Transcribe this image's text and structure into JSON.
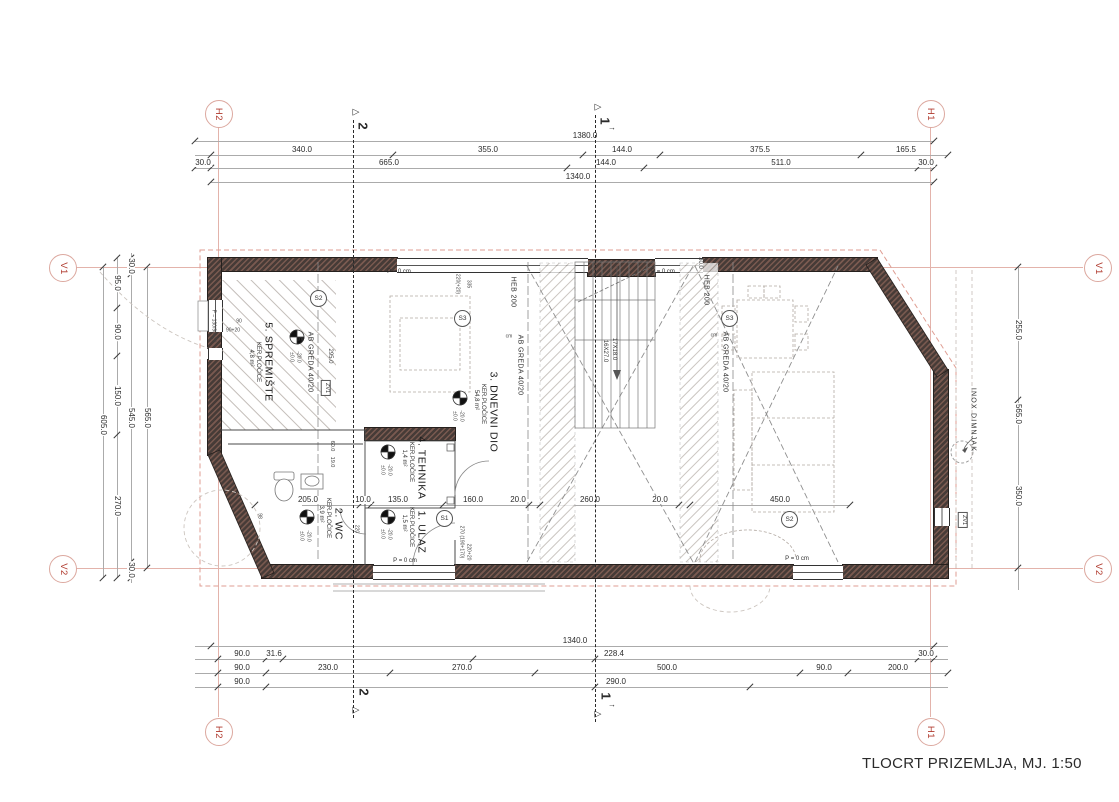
{
  "title": {
    "text": "TLOCRT PRIZEMLJA, MJ. 1:50"
  },
  "colors": {
    "wall": "#463b37",
    "wall_hatch": "#7a5a50",
    "grid_red": "#b03a2e",
    "grid_line": "#e3b3ab",
    "roof_dashed": "#df9e93",
    "dim_text": "#2b2b2b"
  },
  "grid": {
    "markers": [
      {
        "t": "H2",
        "x": 218,
        "y": 113
      },
      {
        "t": "H1",
        "x": 930,
        "y": 113
      },
      {
        "t": "V1",
        "x": 62,
        "y": 267
      },
      {
        "t": "V1",
        "x": 1097,
        "y": 267
      },
      {
        "t": "V2",
        "x": 62,
        "y": 568
      },
      {
        "t": "V2",
        "x": 1097,
        "y": 568
      },
      {
        "t": "H2",
        "x": 218,
        "y": 731
      },
      {
        "t": "H1",
        "x": 930,
        "y": 731
      }
    ],
    "lines": [
      {
        "o": "v",
        "x": 218,
        "y1": 127,
        "y2": 717
      },
      {
        "o": "v",
        "x": 930,
        "y1": 127,
        "y2": 717
      },
      {
        "o": "h",
        "y": 267,
        "x1": 76,
        "x2": 1083
      },
      {
        "o": "h",
        "y": 568,
        "x1": 76,
        "x2": 1083
      }
    ]
  },
  "sections": [
    {
      "label": "2",
      "x": 353,
      "y1": 120,
      "y2": 718
    },
    {
      "label": "1",
      "x": 595,
      "y1": 115,
      "y2": 722
    }
  ],
  "dimensions": {
    "h_rows": [
      {
        "y": 141,
        "x1": 195,
        "x2": 934,
        "ticks": [
          195,
          934
        ],
        "labels": [
          {
            "t": "1380.0",
            "x": 585
          }
        ]
      },
      {
        "y": 155,
        "x1": 195,
        "x2": 948,
        "ticks": [
          211,
          393,
          583,
          660,
          861,
          948
        ],
        "labels": [
          {
            "t": "340.0",
            "x": 302
          },
          {
            "t": "355.0",
            "x": 488
          },
          {
            "t": "144.0",
            "x": 622
          },
          {
            "t": "375.5",
            "x": 760
          },
          {
            "t": "165.5",
            "x": 906
          }
        ]
      },
      {
        "y": 168,
        "x1": 195,
        "x2": 934,
        "ticks": [
          195,
          211,
          567,
          644,
          918,
          934
        ],
        "labels": [
          {
            "t": "30.0",
            "x": 203
          },
          {
            "t": "665.0",
            "x": 389
          },
          {
            "t": "144.0",
            "x": 606
          },
          {
            "t": "511.0",
            "x": 781
          },
          {
            "t": "30.0",
            "x": 926
          }
        ]
      },
      {
        "y": 182,
        "x1": 211,
        "x2": 934,
        "ticks": [
          211,
          934
        ],
        "labels": [
          {
            "t": "1340.0",
            "x": 578
          }
        ]
      },
      {
        "y": 505,
        "x1": 302,
        "x2": 850,
        "ticks": [
          255,
          360,
          371,
          443,
          529,
          540,
          679,
          690,
          850
        ],
        "labels": [
          {
            "t": "205.0",
            "x": 308
          },
          {
            "t": "10.0",
            "x": 363
          },
          {
            "t": "135.0",
            "x": 398
          },
          {
            "t": "160.0",
            "x": 473
          },
          {
            "t": "20.0",
            "x": 518
          },
          {
            "t": "260.0",
            "x": 590
          },
          {
            "t": "20.0",
            "x": 660
          },
          {
            "t": "450.0",
            "x": 780
          }
        ]
      },
      {
        "y": 646,
        "x1": 195,
        "x2": 948,
        "ticks": [
          211,
          934
        ],
        "labels": [
          {
            "t": "1340.0",
            "x": 575
          }
        ]
      },
      {
        "y": 659,
        "x1": 195,
        "x2": 948,
        "ticks": [
          218,
          266,
          283,
          473,
          595,
          918,
          934
        ],
        "labels": [
          {
            "t": "90.0",
            "x": 242
          },
          {
            "t": "31.6",
            "x": 274
          },
          {
            "t": "228.4",
            "x": 614
          },
          {
            "t": "30.0",
            "x": 926
          }
        ]
      },
      {
        "y": 673,
        "x1": 195,
        "x2": 948,
        "ticks": [
          218,
          266,
          390,
          535,
          800,
          848,
          948
        ],
        "labels": [
          {
            "t": "90.0",
            "x": 242
          },
          {
            "t": "230.0",
            "x": 328
          },
          {
            "t": "270.0",
            "x": 462
          },
          {
            "t": "500.0",
            "x": 667
          },
          {
            "t": "90.0",
            "x": 824
          },
          {
            "t": "200.0",
            "x": 898
          }
        ]
      },
      {
        "y": 687,
        "x1": 195,
        "x2": 948,
        "ticks": [
          218,
          266,
          595,
          750
        ],
        "labels": [
          {
            "t": "90.0",
            "x": 242
          },
          {
            "t": "290.0",
            "x": 616
          }
        ]
      }
    ],
    "v_cols": [
      {
        "x": 103,
        "y1": 267,
        "y2": 578,
        "ticks": [
          267,
          578
        ],
        "labels": [
          {
            "t": "605.0",
            "y": 425
          }
        ]
      },
      {
        "x": 117,
        "y1": 258,
        "y2": 578,
        "ticks": [
          258,
          308,
          356,
          435,
          578
        ],
        "labels": [
          {
            "t": "95.0",
            "y": 283
          },
          {
            "t": "90.0",
            "y": 332
          },
          {
            "t": "150.0",
            "y": 396
          },
          {
            "t": "270.0",
            "y": 506
          }
        ]
      },
      {
        "x": 131,
        "y1": 253,
        "y2": 583,
        "ticks": [
          258,
          274,
          562,
          578
        ],
        "labels": [
          {
            "t": "30.0",
            "y": 266
          },
          {
            "t": "545.0",
            "y": 418
          },
          {
            "t": "30.0",
            "y": 570
          }
        ]
      },
      {
        "x": 147,
        "y1": 267,
        "y2": 568,
        "ticks": [
          267,
          568
        ],
        "labels": [
          {
            "t": "565.0",
            "y": 418
          }
        ]
      },
      {
        "x": 1018,
        "y1": 267,
        "y2": 590,
        "ticks": [
          267,
          400,
          568
        ],
        "labels": [
          {
            "t": "255.0",
            "y": 330
          },
          {
            "t": "565.0",
            "y": 414
          },
          {
            "t": "350.0",
            "y": 496
          }
        ]
      }
    ]
  },
  "labels": {
    "rooms": [
      {
        "t": "5. SPREMIŠTE",
        "x": 268,
        "y": 362
      },
      {
        "t": "3. DNEVNI DIO",
        "x": 493,
        "y": 412
      },
      {
        "t": "4. TEHNIKA",
        "x": 421,
        "y": 468
      },
      {
        "t": "2. WC",
        "x": 338,
        "y": 524
      },
      {
        "t": "1. ULAZ",
        "x": 421,
        "y": 532
      }
    ],
    "room_subs": [
      {
        "t": "KER.PLOČICE",
        "x": 258,
        "y": 362
      },
      {
        "t": "4,8 m²",
        "x": 251,
        "y": 358
      },
      {
        "t": "KER.PLOČICE",
        "x": 483,
        "y": 404
      },
      {
        "t": "54,8 m²",
        "x": 476,
        "y": 400
      },
      {
        "t": "KER.PLOČICE",
        "x": 411,
        "y": 462
      },
      {
        "t": "1,4 m²",
        "x": 404,
        "y": 458
      },
      {
        "t": "KER.PLOČICE",
        "x": 328,
        "y": 518
      },
      {
        "t": "3,9 m²",
        "x": 321,
        "y": 514
      },
      {
        "t": "KER.PLOČICE",
        "x": 411,
        "y": 527
      },
      {
        "t": "1,5 m²",
        "x": 404,
        "y": 523
      }
    ],
    "beams": [
      {
        "t": "AB GREDA 40/20",
        "x": 310,
        "y": 362
      },
      {
        "t": "AB GREDA 40/20",
        "x": 520,
        "y": 365
      },
      {
        "t": "AB GREDA 40/20",
        "x": 725,
        "y": 362
      },
      {
        "t": "HEB 200",
        "x": 513,
        "y": 292
      },
      {
        "t": "HEB 200",
        "x": 706,
        "y": 290
      }
    ],
    "stair": [
      {
        "t": "17X18.0",
        "x": 614,
        "y": 349
      },
      {
        "t": "16X27.0",
        "x": 605,
        "y": 351
      }
    ],
    "annotations": [
      {
        "t": "P = 0 cm",
        "x": 399,
        "y": 272
      },
      {
        "t": "P = 0 cm",
        "x": 663,
        "y": 272
      },
      {
        "t": "P = 0 cm",
        "x": 405,
        "y": 561
      },
      {
        "t": "P = 0 cm",
        "x": 797,
        "y": 559
      },
      {
        "t": "→",
        "x": 612,
        "y": 128,
        "s": 8
      },
      {
        "t": "→",
        "x": 612,
        "y": 705,
        "s": 8
      }
    ],
    "tiny": [
      {
        "t": "cm",
        "x": 300,
        "y": 340
      },
      {
        "t": "cm",
        "x": 509,
        "y": 337
      },
      {
        "t": "cm",
        "x": 714,
        "y": 336
      },
      {
        "t": "90",
        "x": 239,
        "y": 322
      },
      {
        "t": "90+20",
        "x": 233,
        "y": 331
      },
      {
        "t": "P = 130/90+20",
        "x": 213,
        "y": 326,
        "r": 1
      },
      {
        "t": "220(+20)",
        "x": 457,
        "y": 284,
        "r": 1
      },
      {
        "t": "335",
        "x": 468,
        "y": 284,
        "r": 1
      },
      {
        "t": "30.0",
        "x": 700,
        "y": 263,
        "r": 1,
        "s": 6
      },
      {
        "t": "295.0",
        "x": 330,
        "y": 356,
        "r": 1,
        "s": 6
      },
      {
        "t": "60.0",
        "x": 331,
        "y": 446,
        "r": 1,
        "s": 5.5
      },
      {
        "t": "19.0",
        "x": 331,
        "y": 462,
        "r": 1,
        "s": 5.5
      },
      {
        "t": "98",
        "x": 259,
        "y": 516,
        "r": 1
      },
      {
        "t": "220",
        "x": 356,
        "y": 529,
        "r": 1
      },
      {
        "t": "270 (190+170)",
        "x": 461,
        "y": 542,
        "r": 1
      },
      {
        "t": "220+20",
        "x": 468,
        "y": 552,
        "r": 1
      },
      {
        "t": "±0.0",
        "x": 291,
        "y": 357,
        "r": 1
      },
      {
        "t": "-20.0",
        "x": 298,
        "y": 357,
        "r": 1
      },
      {
        "t": "±0.0",
        "x": 454,
        "y": 416,
        "r": 1
      },
      {
        "t": "-20.0",
        "x": 461,
        "y": 416,
        "r": 1
      },
      {
        "t": "±0.0",
        "x": 382,
        "y": 470,
        "r": 1
      },
      {
        "t": "-20.0",
        "x": 389,
        "y": 470,
        "r": 1
      },
      {
        "t": "±0.0",
        "x": 382,
        "y": 534,
        "r": 1
      },
      {
        "t": "-20.0",
        "x": 389,
        "y": 534,
        "r": 1
      },
      {
        "t": "±0.0",
        "x": 301,
        "y": 536,
        "r": 1
      },
      {
        "t": "-20.0",
        "x": 308,
        "y": 536,
        "r": 1
      }
    ],
    "chimney": [
      {
        "t": "INOX DIMNJAK",
        "x": 973,
        "y": 420
      }
    ]
  },
  "s_markers": [
    {
      "t": "S2",
      "x": 317,
      "y": 297
    },
    {
      "t": "S3",
      "x": 461,
      "y": 317
    },
    {
      "t": "S3",
      "x": 728,
      "y": 317
    },
    {
      "t": "S1",
      "x": 443,
      "y": 517
    },
    {
      "t": "S2",
      "x": 788,
      "y": 518
    }
  ],
  "zv_tags": [
    {
      "t": "ZV1",
      "x": 326,
      "y": 388
    },
    {
      "t": "ZV1",
      "x": 963,
      "y": 520
    }
  ]
}
